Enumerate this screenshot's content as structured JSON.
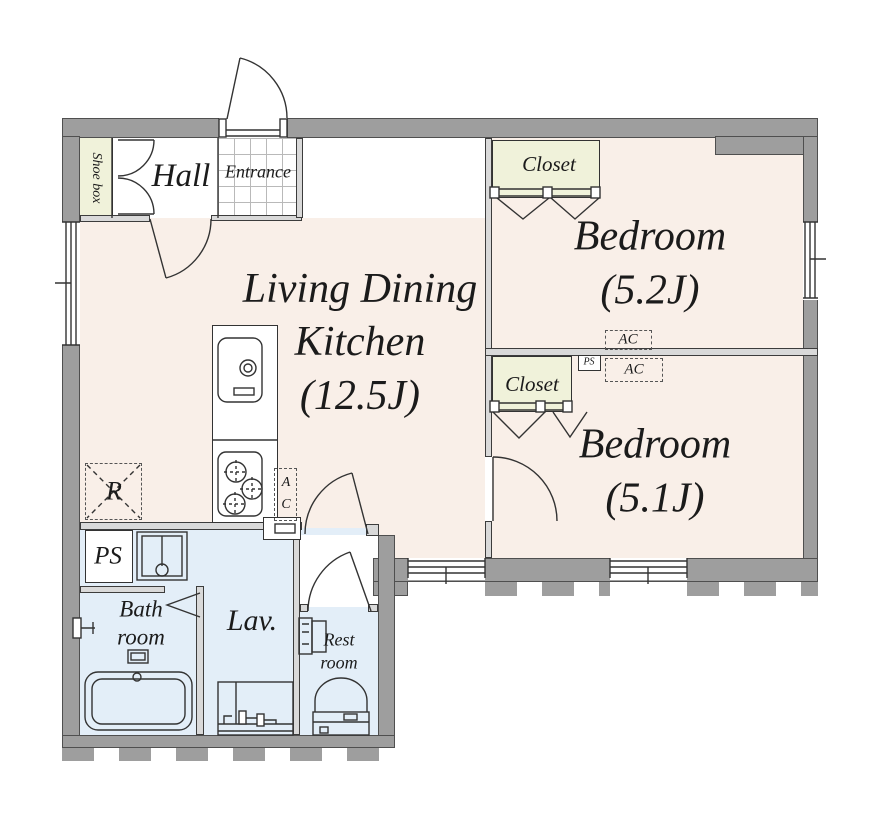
{
  "plan": {
    "hall": "Hall",
    "entrance": "Entrance",
    "shoe_box": "Shoe box",
    "ldk_line1": "Living Dining",
    "ldk_line2": "Kitchen",
    "ldk_line3": "(12.5J)",
    "bedroom_upper_name": "Bedroom",
    "bedroom_upper_size": "(5.2J)",
    "bedroom_lower_name": "Bedroom",
    "bedroom_lower_size": "(5.1J)",
    "closet_upper": "Closet",
    "closet_lower": "Closet",
    "bath_line1": "Bath",
    "bath_line2": "room",
    "lav": "Lav.",
    "rest_line1": "Rest",
    "rest_line2": "room",
    "ac_upper": "AC",
    "ac_lower": "AC",
    "ac_kitchen_a": "A",
    "ac_kitchen_c": "C",
    "ps_utility": "PS",
    "ps_closet": "PS",
    "refrigerator": "R"
  },
  "colors": {
    "wall": "#9e9e9e",
    "floor": "#f9efe8",
    "closet_fill": "#f0f2da",
    "wet_area": "#e3eef8",
    "line": "#333333"
  }
}
